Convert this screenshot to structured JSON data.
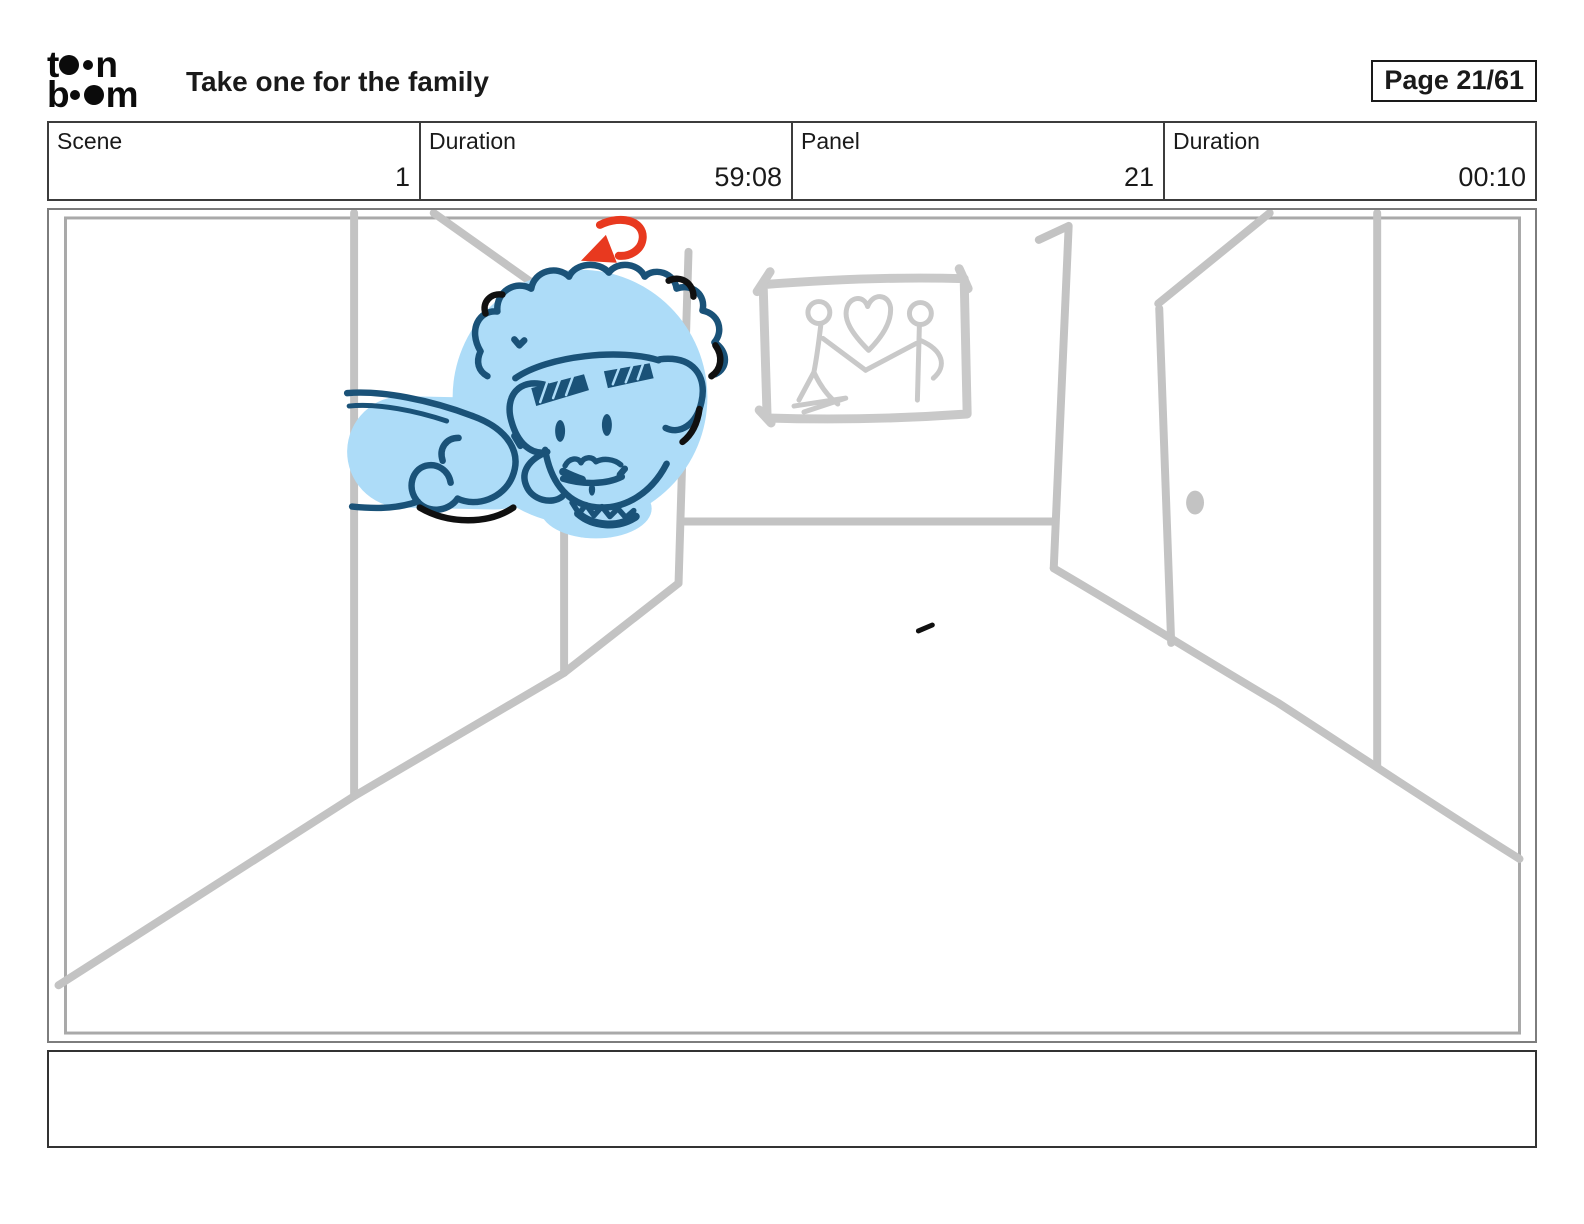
{
  "header": {
    "logo": {
      "brand": "toon boom",
      "line1_pre": "t",
      "line1_post": "n",
      "line2_pre": "b",
      "line2_post": "m"
    },
    "title": "Take one for the family",
    "page_indicator": "Page 21/61"
  },
  "info_row": {
    "cells": [
      {
        "label": "Scene",
        "value": "1"
      },
      {
        "label": "Duration",
        "value": "59:08"
      },
      {
        "label": "Panel",
        "value": "21"
      },
      {
        "label": "Duration",
        "value": "00:10"
      }
    ]
  },
  "storyboard_panel": {
    "caption": "",
    "sketch_description": "Rough gray hallway perspective sketch: man's curly-haired head resting sideways on his arm (light blue fill, dark blue outline), red rotation arrow above head, framed picture of two stick figures holding hands beneath a heart, open door on right wall with doorknob"
  },
  "colors": {
    "text": "#1a1a1a",
    "sketch_gray": "#c3c3c3",
    "frame_gray": "#c9c9c9",
    "character_fill": "#addcf8",
    "character_outline": "#1a5278",
    "accent_black": "#101010",
    "arrow_red": "#e8391f"
  }
}
